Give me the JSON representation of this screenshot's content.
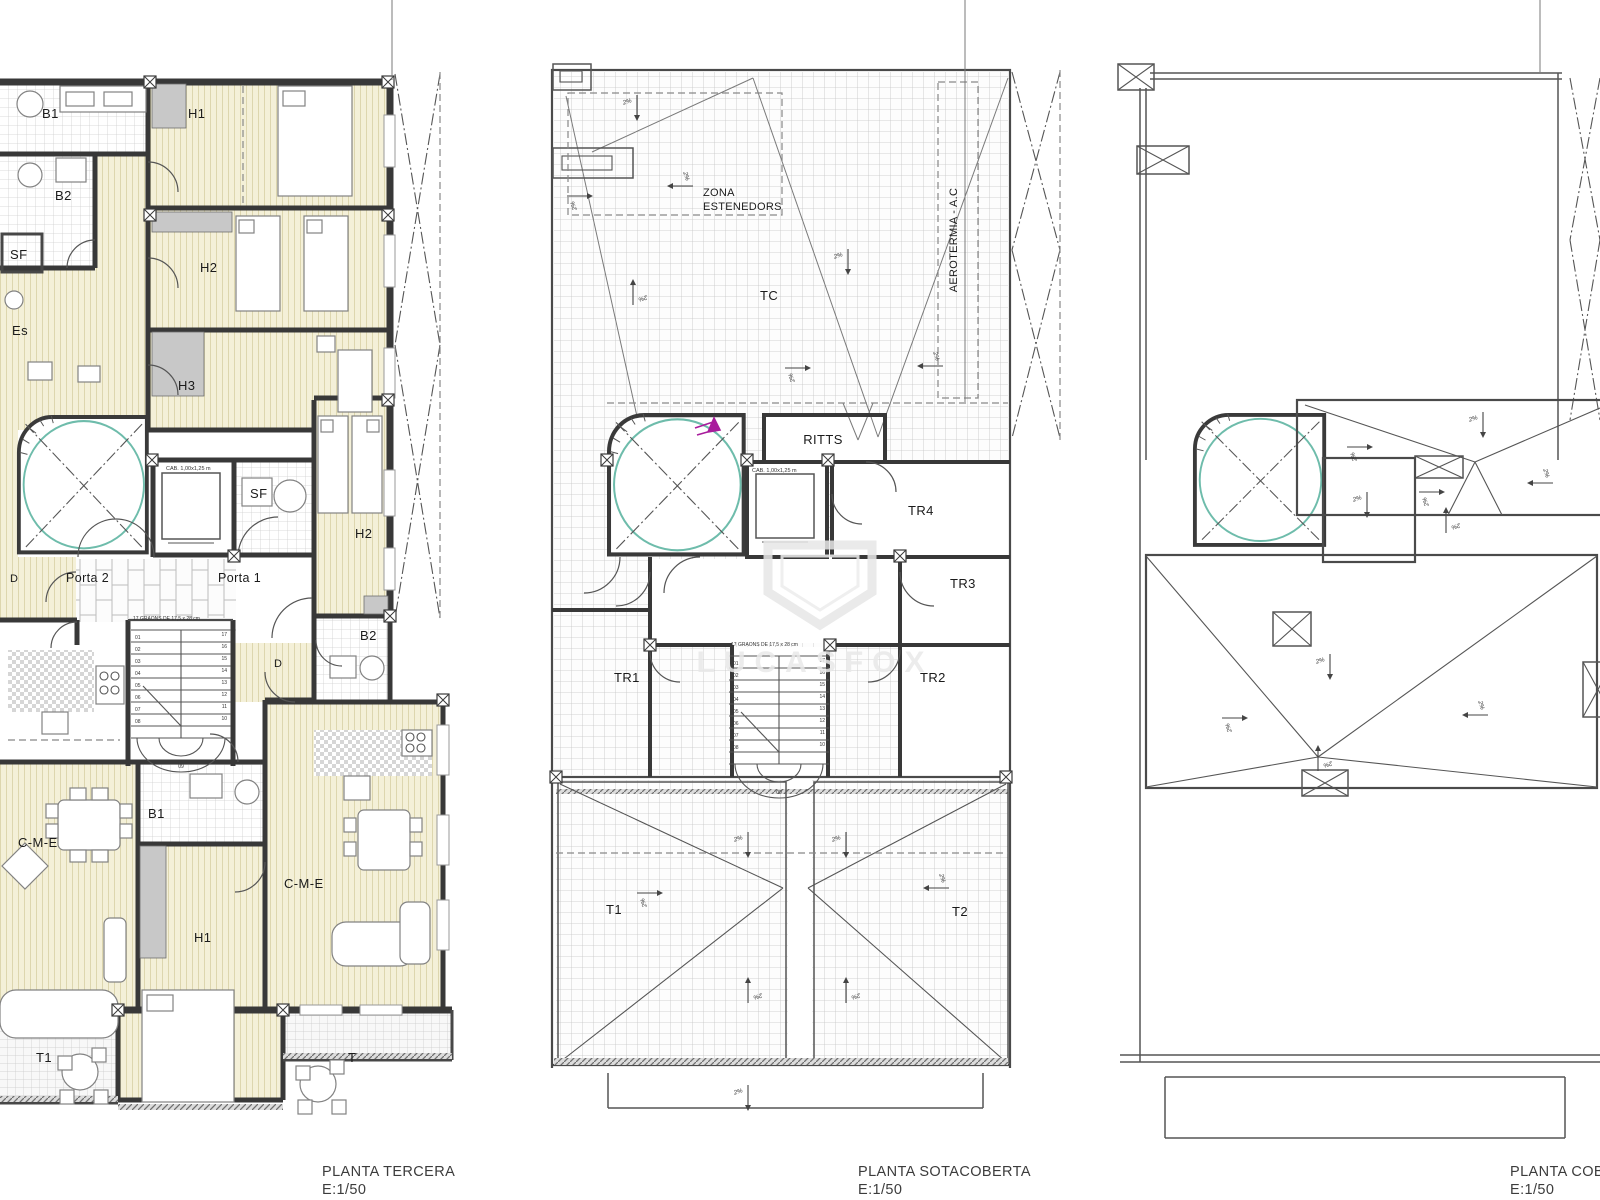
{
  "captions": {
    "tercera": {
      "title": "PLANTA TERCERA",
      "scale": "E:1/50"
    },
    "sotacoberta": {
      "title": "PLANTA SOTACOBERTA",
      "scale": "E:1/50"
    },
    "coberta": {
      "title": "PLANTA COBERTA",
      "scale": "E:1/50"
    }
  },
  "tercera": {
    "labels": {
      "b1": "B1",
      "h1": "H1",
      "b2": "B2",
      "sf": "SF",
      "es": "Es",
      "h2": "H2",
      "h3": "H3",
      "sf2": "SF",
      "h2_2": "H2",
      "porta2": "Porta 2",
      "porta1": "Porta 1",
      "d1": "D",
      "d2": "D",
      "b2_2": "B2",
      "b1_2": "B1",
      "h1_2": "H1",
      "cme1": "C-M-E",
      "cme2": "C-M-E",
      "t1": "T1",
      "t": "T"
    },
    "elevator": "CAB. 1,00x1,25 m",
    "stair_note": "17 GRAONS DE 17,5 x 28 cm"
  },
  "sotacoberta": {
    "labels": {
      "zona_line1": "ZONA",
      "zona_line2": "ESTENEDORS",
      "tc": "TC",
      "aerotermia": "AEROTERMIA - A.C",
      "ritts": "RITTS",
      "tr1": "TR1",
      "tr2": "TR2",
      "tr3": "TR3",
      "tr4": "TR4",
      "t1": "T1",
      "t2": "T2"
    },
    "elevator": "CAB. 1,00x1,25 m",
    "stair_note": "17 GRAONS DE 17,5 x 28 cm"
  },
  "stairs": {
    "left_numbers": [
      "01",
      "02",
      "03",
      "04",
      "05",
      "06",
      "07",
      "08"
    ],
    "right_top": "17",
    "right_numbers": [
      "16",
      "15",
      "14",
      "13",
      "12",
      "11",
      "10"
    ],
    "bottom": "09"
  },
  "annotations": {
    "slope_label": "2%",
    "slope_arrows": [
      {
        "x": 637,
        "y": 108,
        "d": "d"
      },
      {
        "x": 580,
        "y": 196,
        "d": "r"
      },
      {
        "x": 680,
        "y": 186,
        "d": "l"
      },
      {
        "x": 848,
        "y": 262,
        "d": "d"
      },
      {
        "x": 633,
        "y": 292,
        "d": "u"
      },
      {
        "x": 798,
        "y": 368,
        "d": "r"
      },
      {
        "x": 930,
        "y": 366,
        "d": "l"
      },
      {
        "x": 748,
        "y": 845,
        "d": "d"
      },
      {
        "x": 846,
        "y": 845,
        "d": "d"
      },
      {
        "x": 650,
        "y": 893,
        "d": "r"
      },
      {
        "x": 936,
        "y": 888,
        "d": "l"
      },
      {
        "x": 748,
        "y": 990,
        "d": "u"
      },
      {
        "x": 846,
        "y": 990,
        "d": "u"
      },
      {
        "x": 748,
        "y": 1098,
        "d": "d"
      },
      {
        "x": 1483,
        "y": 425,
        "d": "d"
      },
      {
        "x": 1360,
        "y": 447,
        "d": "r"
      },
      {
        "x": 1432,
        "y": 492,
        "d": "r"
      },
      {
        "x": 1446,
        "y": 520,
        "d": "u"
      },
      {
        "x": 1540,
        "y": 483,
        "d": "l"
      },
      {
        "x": 1367,
        "y": 505,
        "d": "d"
      },
      {
        "x": 1330,
        "y": 667,
        "d": "d"
      },
      {
        "x": 1235,
        "y": 718,
        "d": "r"
      },
      {
        "x": 1475,
        "y": 715,
        "d": "l"
      },
      {
        "x": 1318,
        "y": 758,
        "d": "u"
      }
    ]
  },
  "watermark": {
    "text": "LUCASFOX"
  }
}
